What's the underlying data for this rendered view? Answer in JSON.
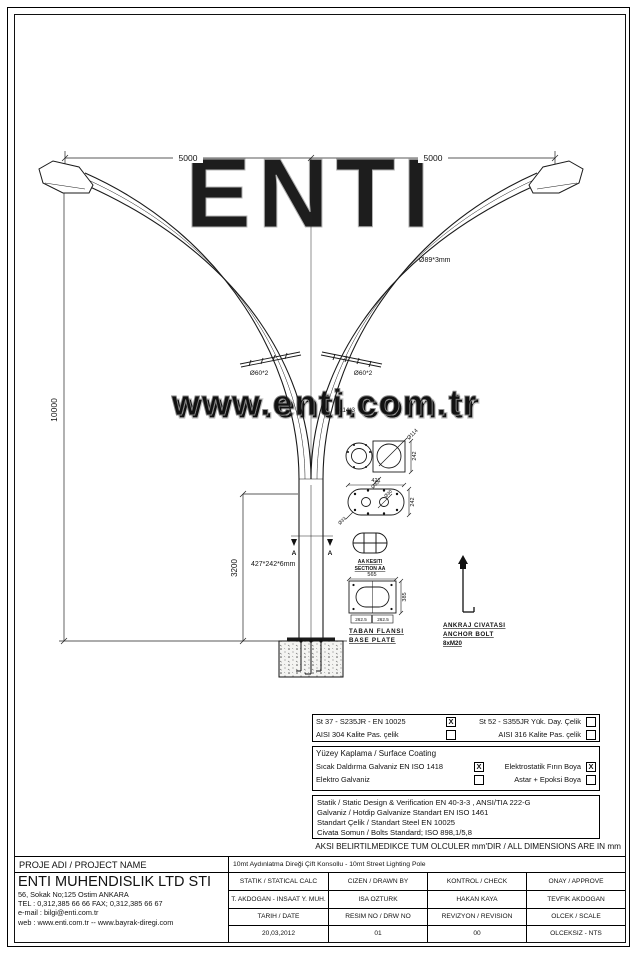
{
  "watermarks": {
    "logo_text": "ENTI",
    "site_text": "www.enti.com.tr"
  },
  "drawing": {
    "dims": {
      "arm_left": "5000",
      "arm_right": "5000",
      "total_height": "10000",
      "base_section_height": "3200"
    },
    "labels": {
      "arm_tube": "Ø89*3mm",
      "bracket_left": "Ø60*2",
      "bracket_right": "Ø60*2",
      "pole_tube": "Ø114*3",
      "pole_section": "427*242*6mm",
      "section_marker": "A"
    },
    "details": {
      "twin_section": {
        "dim_diameter": "Ø114",
        "dim_height": "242",
        "dim_offset": "Ø33"
      },
      "oval_plate": {
        "dim_width": "421",
        "dim_height": "242",
        "dim_hole": "Ø33",
        "dim_center_hole": "Ø30"
      },
      "section_aa": {
        "title_tr": "AA KESITI",
        "title_en": "SECTION AA"
      },
      "base_plate": {
        "dim_width": "565",
        "dim_height": "385",
        "dim_left": "262.5",
        "dim_right": "262.5",
        "title_tr": "TABAN FLANSI",
        "title_en": "BASE PLATE"
      },
      "anchor_bolt": {
        "title_tr": "ANKRAJ CIVATASI",
        "title_en": "ANCHOR BOLT",
        "spec": "8xM20"
      }
    }
  },
  "spec": {
    "material": {
      "r1c1": "St 37 - S235JR - EN 10025",
      "r1c1_mark": "X",
      "r1c2": "St 52 - S355JR Yük. Day. Çelik",
      "r1c2_mark": "",
      "r2c1": "AISI 304 Kalite Pas. çelik",
      "r2c1_mark": "",
      "r2c2": "AISI 316 Kalite Pas. çelik",
      "r2c2_mark": ""
    },
    "coating": {
      "title": "Yüzey Kaplama / Surface Coating",
      "opt1": "Sıcak Daldırma Galvaniz EN ISO 1418",
      "opt1_mark": "X",
      "opt2": "Elektrostatik Fırın Boya",
      "opt2_mark": "X",
      "opt3": "Elektro Galvaniz",
      "opt3_mark": "",
      "opt4": "Astar + Epoksi Boya",
      "opt4_mark": ""
    },
    "standards": {
      "line1": "Statik / Static Design & Verification EN 40-3-3 , ANSI/TIA 222-G",
      "line2": "Galvaniz / Hotdip Galvanize Standart EN ISO 1461",
      "line3": "Standart Çelik / Standart Steel EN 10025",
      "line4": "Civata Somun / Bolts Standard; ISO 898,1/5,8"
    },
    "note": "AKSI BELIRTILMEDIKCE TUM OLCULER mm'DIR / ALL DIMENSIONS ARE IN mm"
  },
  "title_block": {
    "project_label": "PROJE ADI / PROJECT NAME",
    "project_name": "10mt Aydınlatma Direği Çift Konsollu - 10mt Street Lighting Pole",
    "company_name": "ENTI MUHENDISLIK LTD STI",
    "company_address": "56, Sokak No;125 Ostim ANKARA",
    "company_phone": "TEL : 0,312,385 66 66  FAX; 0,312,385 66 67",
    "company_email": "e-mail : bilgi@enti.com.tr",
    "company_web": "web   : www.enti.com.tr  --  www.bayrak-diregi.com",
    "h_statik": "STATIK / STATICAL CALC",
    "v_statik": "T. AKDOGAN - INSAAT Y. MUH.",
    "h_cizen": "CIZEN / DRAWN BY",
    "v_cizen": "ISA OZTURK",
    "h_kontrol": "KONTROL / CHECK",
    "v_kontrol": "HAKAN KAYA",
    "h_onay": "ONAY / APPROVE",
    "v_onay": "TEVFIK AKDOGAN",
    "h_tarih": "TARIH / DATE",
    "v_tarih": "20,03,2012",
    "h_resim": "RESIM NO / DRW NO",
    "v_resim": "01",
    "h_rev": "REVIZYON / REVISION",
    "v_rev": "00",
    "h_olcek": "OLCEK / SCALE",
    "v_olcek": "OLCEKSIZ - NTS"
  }
}
